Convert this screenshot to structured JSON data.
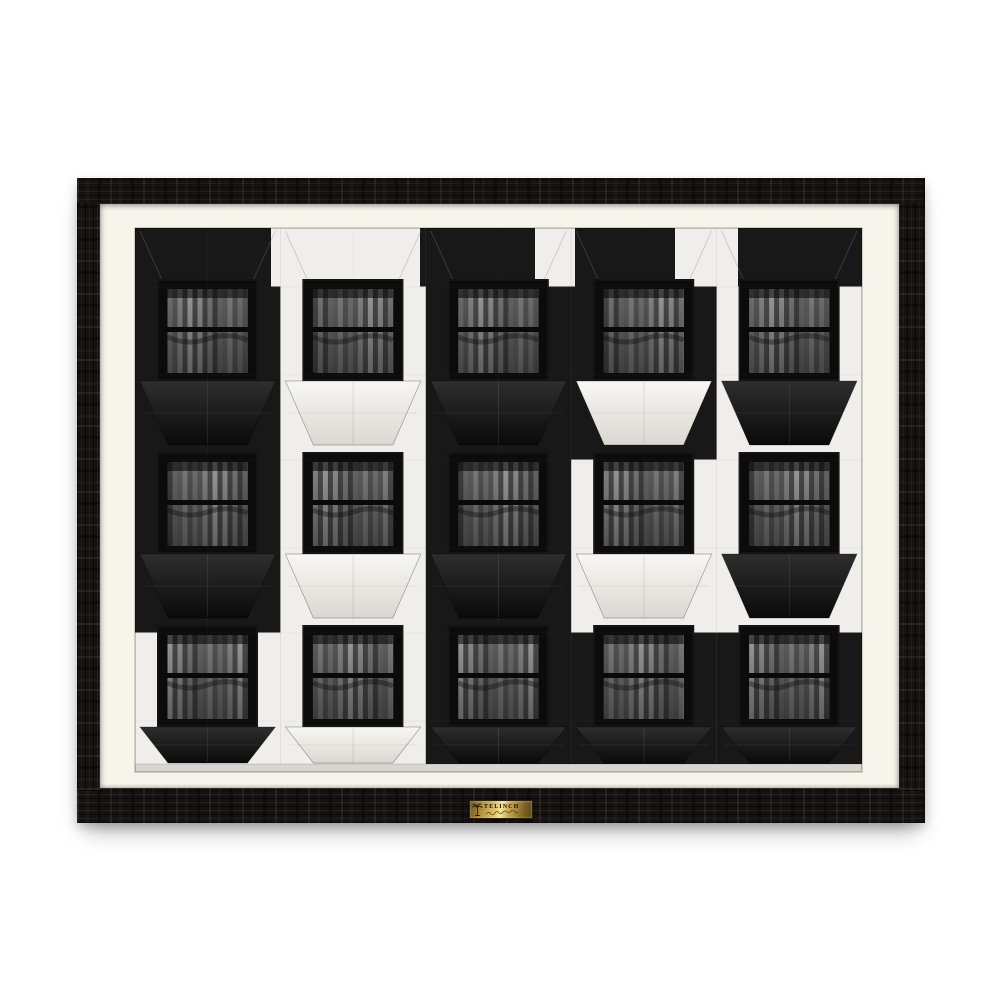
{
  "artwork": {
    "description": "black and white photograph of a geometric building facade, framed in a black wood frame with white mat",
    "plaque": {
      "brand": "TELINCH",
      "icon": "palm-tree-icon"
    },
    "colors": {
      "page_bg": "#ffffff",
      "frame_black": "#15120f",
      "mat_white": "#f7f4ec",
      "panel_black": "#181818",
      "panel_white": "#efeeea",
      "window_frame": "#0b0b0b",
      "curtain_palette": [
        "#707070",
        "#4c4c4c",
        "#8d8d8d",
        "#3f3f3f",
        "#7c7c7c",
        "#585858",
        "#9a9a9a",
        "#454545",
        "#666666",
        "#535353",
        "#858585",
        "#494949",
        "#757575",
        "#5e5e5e"
      ],
      "sill_light": "#d7d6d1",
      "plaque_gold_light": "#f6e59c",
      "plaque_gold_dark": "#6b531f",
      "plaque_text_color": "#1a1303"
    },
    "facade": {
      "cols": 5,
      "rows_count": 3,
      "top_band_colors": [
        "B",
        "W",
        "B",
        "W",
        "B",
        "W",
        "B"
      ],
      "top_band_widths": [
        136,
        149,
        115,
        40,
        100,
        63,
        124
      ],
      "rows": [
        {
          "fields": [
            "B",
            "W",
            "B",
            "B",
            "W"
          ],
          "prisms": [
            "B",
            "W",
            "B",
            "W",
            "B"
          ]
        },
        {
          "fields": [
            "B",
            "W",
            "B",
            "W",
            "W"
          ],
          "prisms": [
            "B",
            "W",
            "B",
            "W",
            "B"
          ]
        },
        {
          "fields": [
            "W",
            "W",
            "B",
            "B",
            "B"
          ],
          "prisms": [
            "B",
            "W",
            "B",
            "B",
            "B"
          ]
        }
      ]
    }
  }
}
